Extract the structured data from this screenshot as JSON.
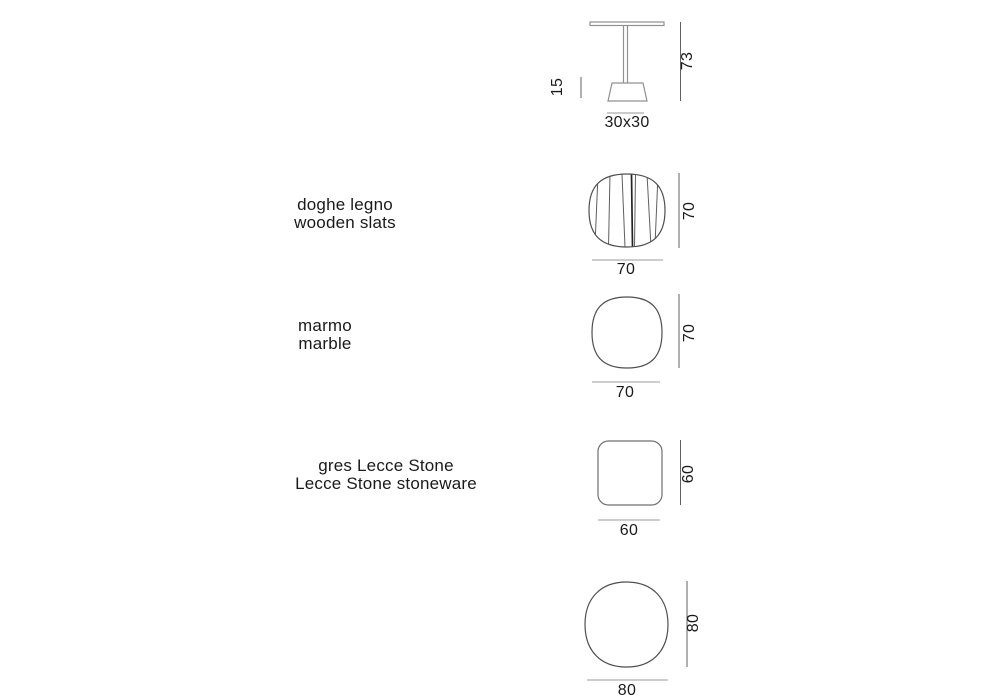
{
  "colors": {
    "text": "#1a1a1a",
    "shape_outline": "#4f4f4f",
    "stoneware_outline": "#6f6f6f",
    "furniture_line": "#909090",
    "dim_line_dark": "#606060",
    "dim_line_light": "#9b9b9b",
    "dim_line_faint": "#b8b8b8",
    "slat_line": "#5f5f5f",
    "slat_line_dark": "#242424"
  },
  "figures": {
    "table_side": {
      "base_height": "15",
      "total_height": "73",
      "top_size": "30x30"
    },
    "wood": {
      "label_it": "doghe legno",
      "label_en": "wooden slats",
      "depth": "70",
      "width": "70"
    },
    "marble": {
      "label_it": "marmo",
      "label_en": "marble",
      "depth": "70",
      "width": "70"
    },
    "stoneware": {
      "label_it": "gres Lecce Stone",
      "label_en": "Lecce Stone stoneware",
      "depth": "60",
      "width": "60"
    },
    "large_top": {
      "depth": "80",
      "width": "80"
    }
  }
}
